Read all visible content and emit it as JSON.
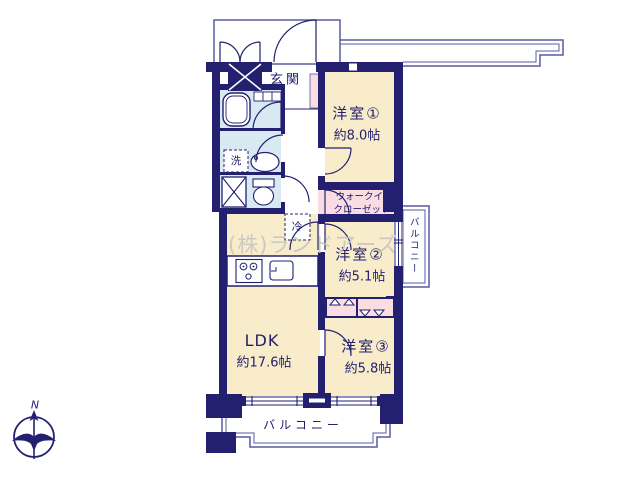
{
  "watermark": "(株)ランドアーズ",
  "compass": {
    "north_label": "N"
  },
  "colors": {
    "wall": "#232070",
    "room": "#f8ecca",
    "closet": "#fadde3",
    "wet_area": "#d8e9f2",
    "outline": "#585aa2"
  },
  "rooms": {
    "entrance": {
      "label": "玄関"
    },
    "room1": {
      "label": "洋室①",
      "size": "約8.0帖"
    },
    "wic": {
      "line1": "ウォークイン",
      "line2": "クローゼット"
    },
    "room2": {
      "label": "洋室②",
      "size": "約5.1帖"
    },
    "room3": {
      "label": "洋室③",
      "size": "約5.8帖"
    },
    "ldk": {
      "label": "LDK",
      "size": "約17.6帖"
    },
    "balcony_right": {
      "label": "バルコニー"
    },
    "balcony_bottom": {
      "label": "バルコニー"
    }
  },
  "fixtures": {
    "refrigerator": "冷",
    "washer": "洗"
  }
}
